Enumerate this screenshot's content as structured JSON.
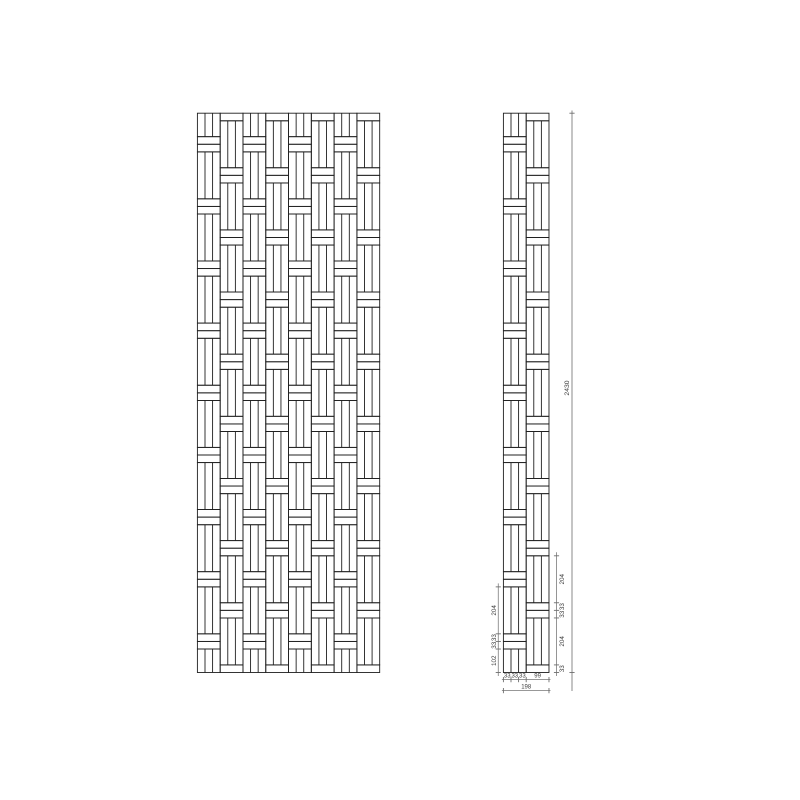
{
  "document": {
    "background": "#ffffff",
    "line_color": "#1f1f1f",
    "dim_line_color": "#8a8a8a",
    "dim_tick_color": "#6e6e6e",
    "dim_text_color": "#3c3c3c"
  },
  "pattern": {
    "panel_height_units": 2430,
    "column_width_units": 99,
    "slat_width_units": 33,
    "band_height_units": 33,
    "cell_height_units": 204,
    "half_cell_units": 102,
    "slats_per_cell": 3,
    "front_view_columns": 8,
    "side_view_columns": 2,
    "full_cells_type_a": 8,
    "full_cells_type_b": 9
  },
  "dimensions": {
    "total_height_label": "2430",
    "side_left_chain_labels_bottom_up": [
      "102",
      "33",
      "33",
      "204"
    ],
    "side_left_chain_units_bottom_up": [
      102,
      33,
      33,
      204
    ],
    "side_right_chain_labels_bottom_up": [
      "33",
      "204",
      "33",
      "33",
      "204"
    ],
    "side_right_chain_units_bottom_up": [
      33,
      204,
      33,
      33,
      204
    ],
    "bottom_slat_labels": [
      "33",
      "33",
      "33"
    ],
    "bottom_slat_units": [
      33,
      33,
      33
    ],
    "bottom_right_label": "99",
    "bottom_right_units": 99,
    "bottom_total_label": "198",
    "bottom_total_units": 198
  }
}
